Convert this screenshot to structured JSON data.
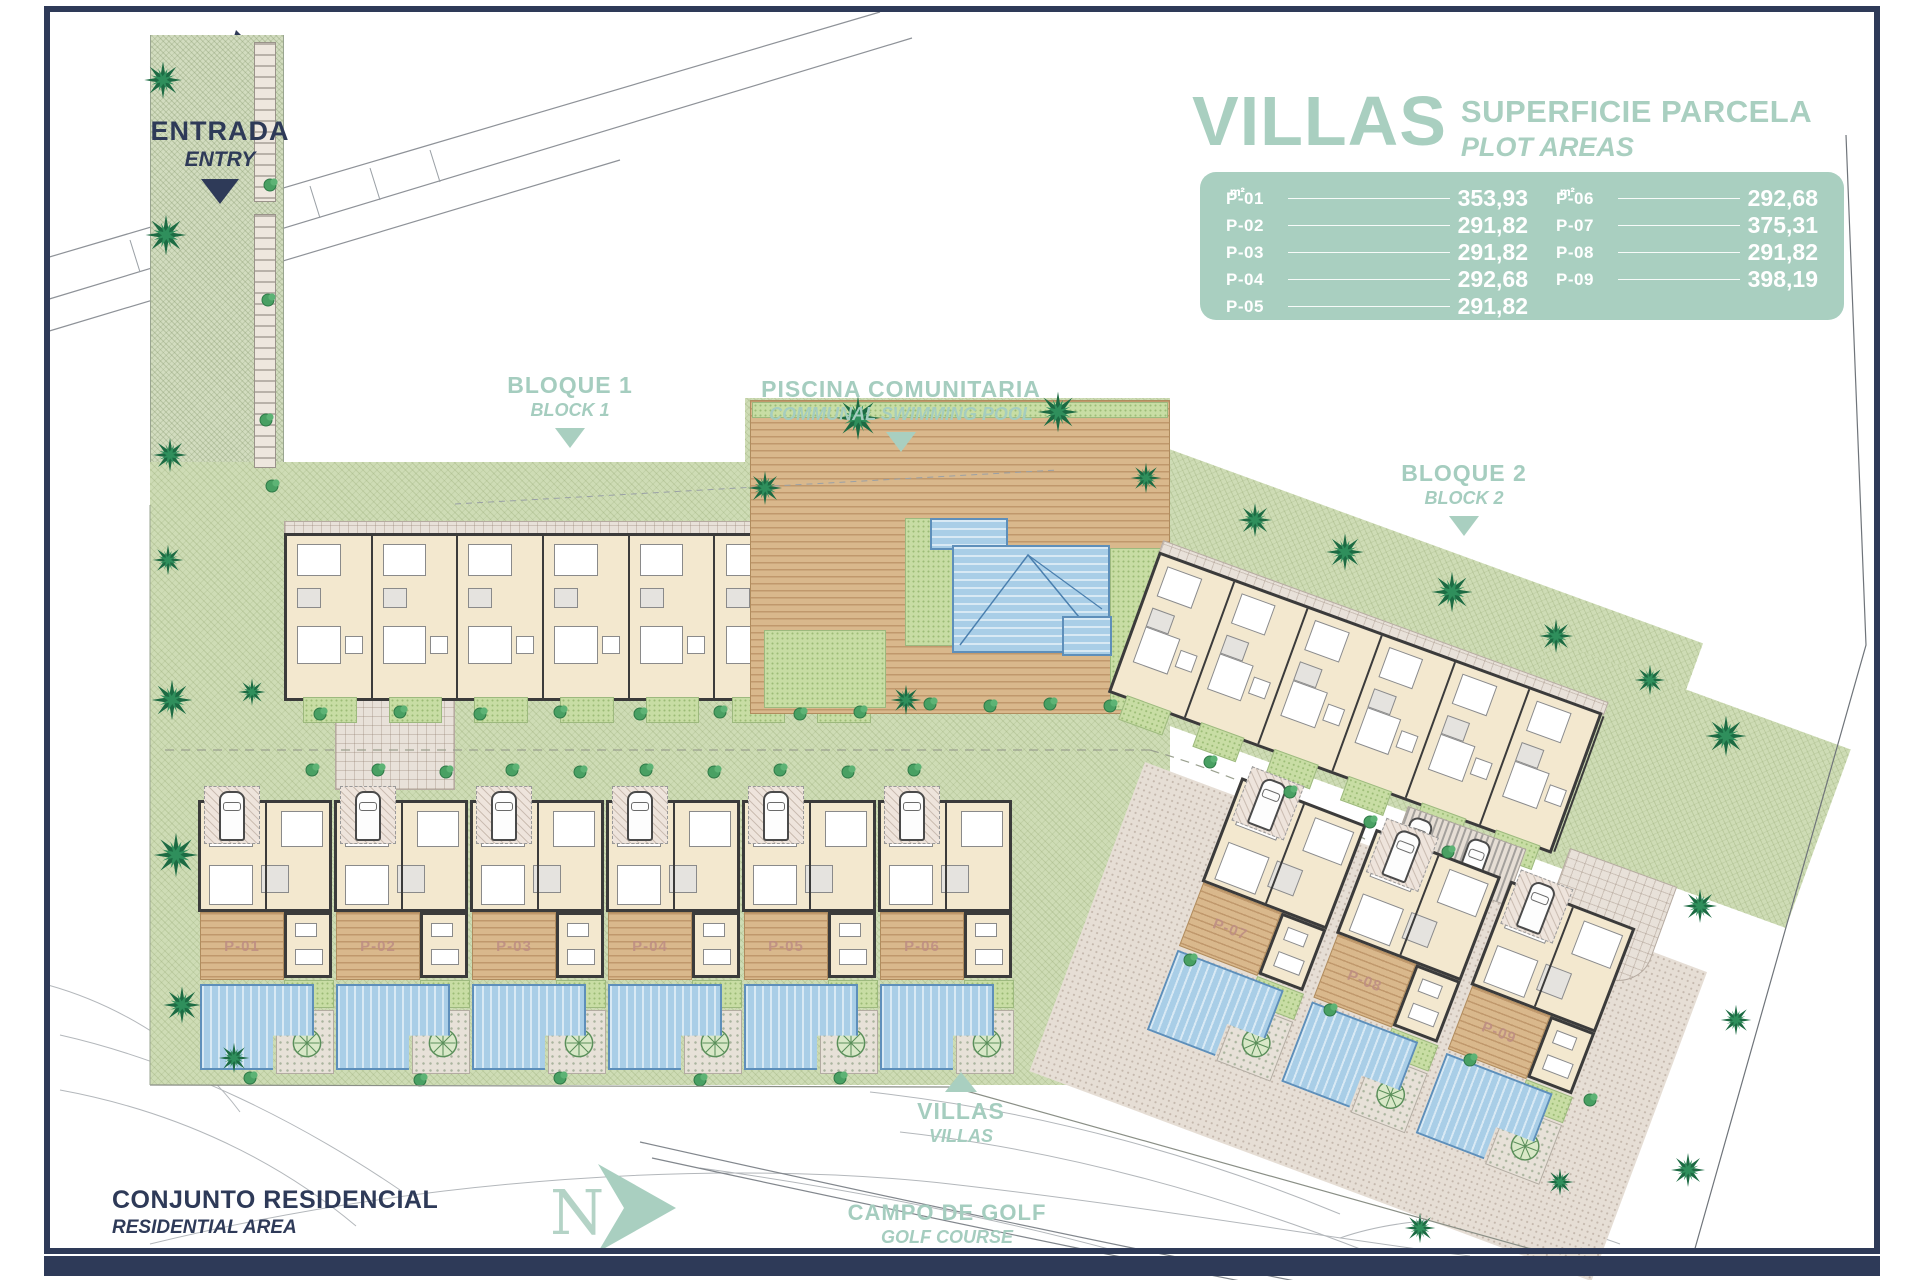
{
  "legend": {
    "title": "VILLAS",
    "subtitle_line1": "SUPERFICIE PARCELA",
    "subtitle_line2": "PLOT AREAS",
    "unit": "m²",
    "panel_color": "#a9cfc0",
    "columns": [
      [
        {
          "label": "P-01",
          "value": "353,93"
        },
        {
          "label": "P-02",
          "value": "291,82"
        },
        {
          "label": "P-03",
          "value": "291,82"
        },
        {
          "label": "P-04",
          "value": "292,68"
        },
        {
          "label": "P-05",
          "value": "291,82"
        }
      ],
      [
        {
          "label": "P-06",
          "value": "292,68"
        },
        {
          "label": "P-07",
          "value": "375,31"
        },
        {
          "label": "P-08",
          "value": "291,82"
        },
        {
          "label": "P-09",
          "value": "398,19"
        }
      ]
    ]
  },
  "markers": {
    "entrada": {
      "title": "ENTRADA",
      "subtitle": "ENTRY"
    },
    "bloque1": {
      "title": "BLOQUE 1",
      "subtitle": "BLOCK 1"
    },
    "piscina": {
      "title": "PISCINA COMUNITARIA",
      "subtitle": "COMMUNAL SWIMMING POOL"
    },
    "bloque2": {
      "title": "BLOQUE 2",
      "subtitle": "BLOCK 2"
    },
    "villas": {
      "title": "VILLAS",
      "subtitle": "VILLAS"
    },
    "conjunto": {
      "title": "CONJUNTO RESIDENCIAL",
      "subtitle": "RESIDENTIAL AREA"
    },
    "campo": {
      "title": "CAMPO DE GOLF",
      "subtitle": "GOLF COURSE"
    },
    "north": {
      "label": "N"
    }
  },
  "plan": {
    "villa_row_labels": [
      "P-01",
      "P-02",
      "P-03",
      "P-04",
      "P-05",
      "P-06"
    ],
    "villa_group_labels": [
      "P-07",
      "P-08",
      "P-09"
    ],
    "colors": {
      "sage_label": "#a5cdbf",
      "navy": "#2e3a58",
      "grounds_green": "#cedcb5",
      "paving": "#e6ded5",
      "deck_wood": "#d9b88c",
      "pool_blue": "#a9cee7",
      "building_cream": "#f3e8cf",
      "wall_dark": "#3b3b3b",
      "palm_green": "#1c6b43",
      "plot_label": "#bd8d83"
    }
  }
}
